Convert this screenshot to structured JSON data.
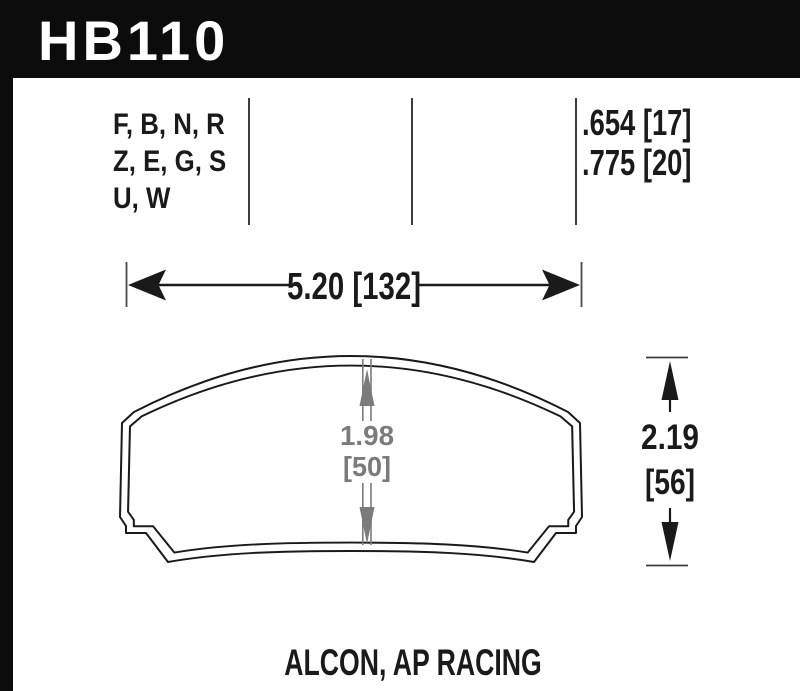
{
  "header": {
    "part_number": "HB110"
  },
  "compound_codes": {
    "lines": [
      "F, B, N, R",
      "Z, E, G, S",
      "U, W"
    ]
  },
  "pad_thickness": {
    "lines": [
      ".654 [17]",
      ".775 [20]"
    ]
  },
  "dimensions": {
    "width": {
      "label": "5.20 [132]"
    },
    "height": {
      "value": "2.19",
      "mm": "[56]"
    },
    "center_height": {
      "value": "1.98",
      "mm": "[50]"
    }
  },
  "footer": {
    "applications": "ALCON, AP RACING"
  },
  "colors": {
    "ink": "#1a1a1a",
    "dim_gray": "#7b7b7b",
    "header_bg": "#0c0c0c"
  }
}
